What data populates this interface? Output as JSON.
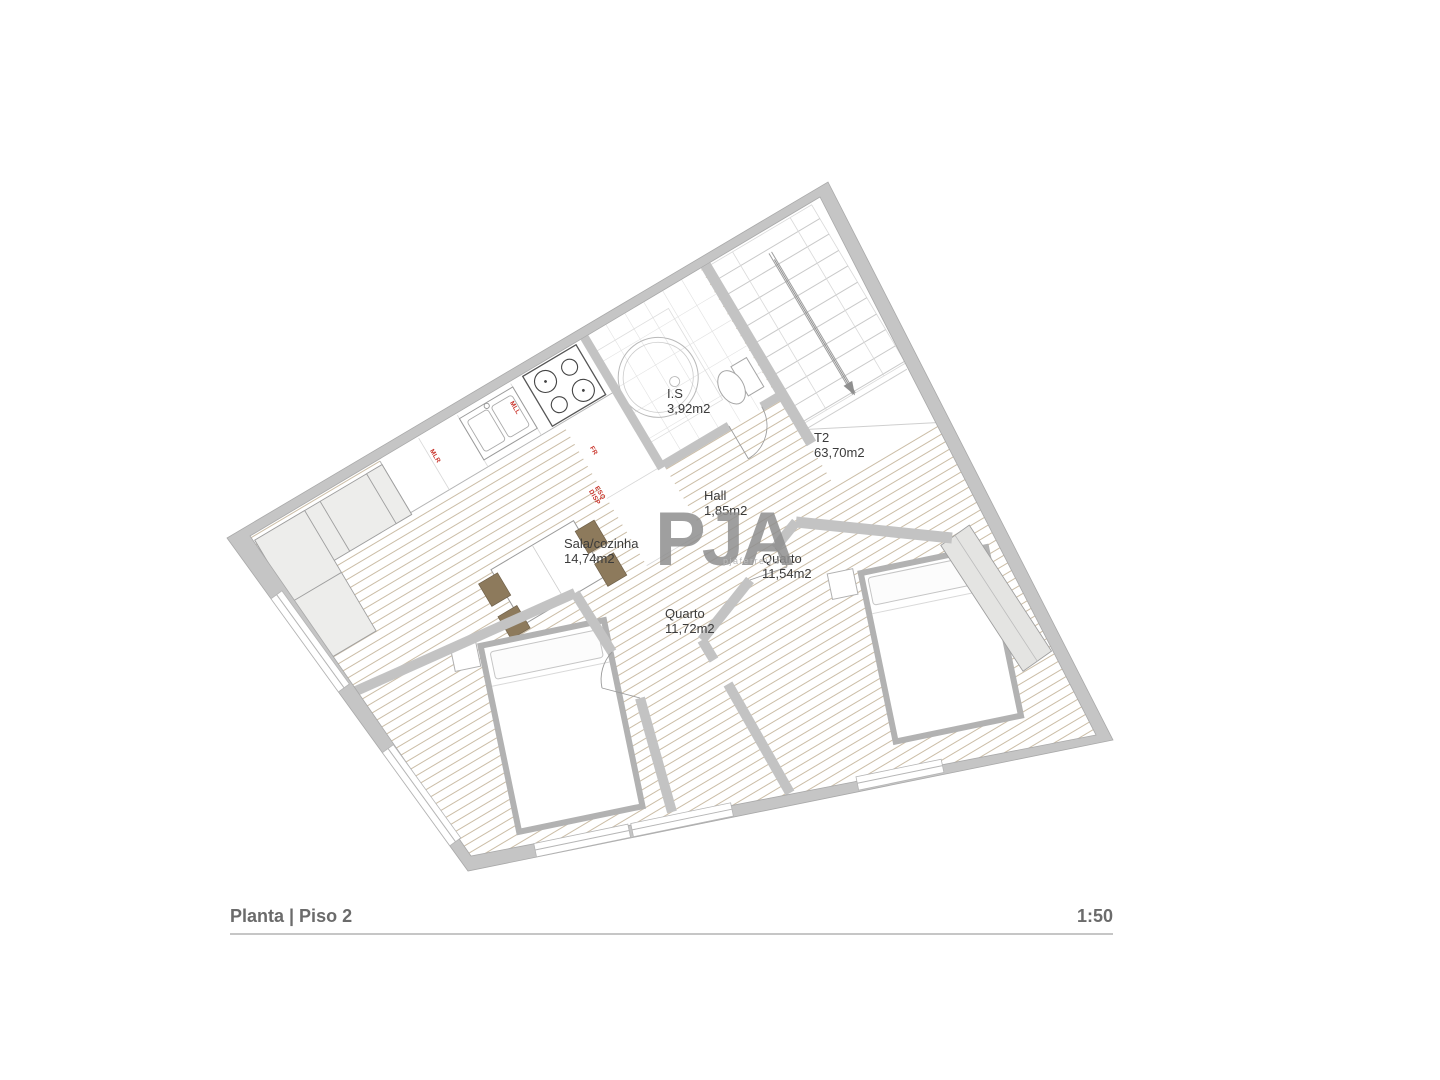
{
  "title": {
    "label": "Planta | Piso 2",
    "scale": "1:50"
  },
  "watermark": {
    "logo": "PJA",
    "tagline": "pjaferreira"
  },
  "rooms": {
    "is": {
      "name": "I.S",
      "area": "3,92m2"
    },
    "t2": {
      "name": "T2",
      "area": "63,70m2"
    },
    "hall": {
      "name": "Hall",
      "area": "1,85m2"
    },
    "sala": {
      "name": "Sala/cozinha",
      "area": "14,74m2"
    },
    "quarto2": {
      "name": "Quarto",
      "area": "11,54m2"
    },
    "quarto1": {
      "name": "Quarto",
      "area": "11,72m2"
    }
  },
  "appliances": {
    "mlr": "MLR",
    "mll": "MLL",
    "fr": "FR",
    "esq": "ESQ",
    "disp": "DISP"
  },
  "colors": {
    "wall": "#c5c5c5",
    "wall_edge": "#a9a9a9",
    "floor_hatch": "#cbbda6",
    "furniture_fill": "#ededeb",
    "furniture_stroke": "#9f9f9f",
    "chair_brown": "#8d7a5c",
    "label_red": "#c9342b",
    "text": "#3b3b3b"
  }
}
